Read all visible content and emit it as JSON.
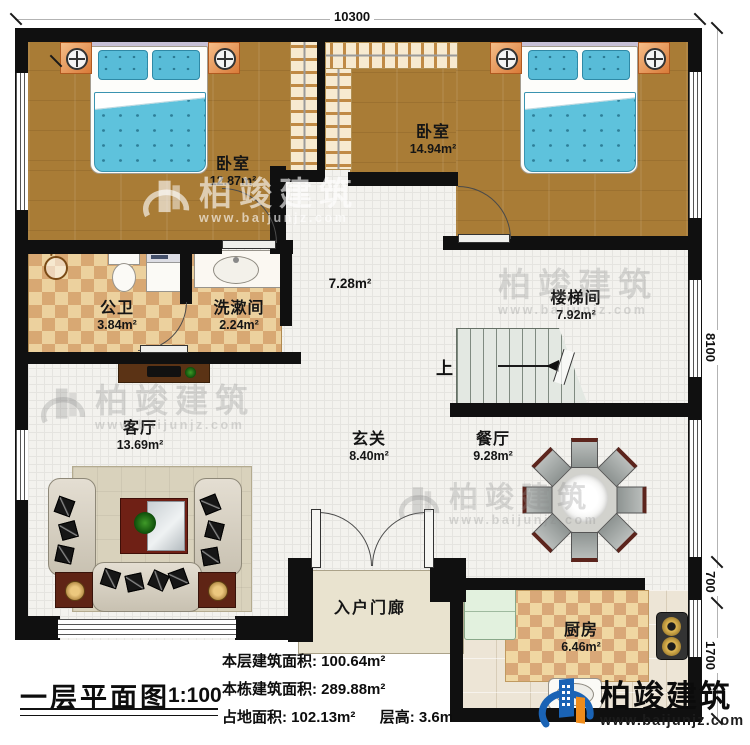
{
  "dimensions": {
    "top": "10300",
    "right_upper": "8100",
    "right_middle": "700",
    "right_lower": "1700"
  },
  "rooms": {
    "bedroom1": {
      "name": "卧室",
      "area": "12.87m²"
    },
    "bedroom2": {
      "name": "卧室",
      "area": "14.94m²"
    },
    "bathroom": {
      "name": "公卫",
      "area": "3.84m²"
    },
    "washroom": {
      "name": "洗漱间",
      "area": "2.24m²"
    },
    "hallway": {
      "area": "7.28m²"
    },
    "stairwell": {
      "name": "楼梯间",
      "area": "7.92m²",
      "up_label": "上"
    },
    "living_room": {
      "name": "客厅",
      "area": "13.69m²"
    },
    "foyer": {
      "name": "玄关",
      "area": "8.40m²"
    },
    "dining_room": {
      "name": "餐厅",
      "area": "9.28m²"
    },
    "entry_porch": {
      "name": "入户门廊"
    },
    "kitchen": {
      "name": "厨房",
      "area": "6.46m²"
    }
  },
  "title_block": {
    "title": "一层平面图",
    "scale": "1:100",
    "stats": {
      "line1_label": "本层建筑面积:",
      "line1_value": "100.64m²",
      "line2_label": "本栋建筑面积:",
      "line2_value": "289.88m²",
      "line3_label": "占地面积:",
      "line3_value": "102.13m²",
      "line3b_label": "层高:",
      "line3b_value": "3.6m"
    }
  },
  "branding": {
    "watermark_name": "柏竣建筑",
    "watermark_url": "www.baijunjz.com",
    "logo_name": "柏竣建筑",
    "logo_url": "www.baijunjz.com"
  },
  "colors": {
    "wall": "#101010",
    "wood_floor": "#a97c36",
    "bed_blue": "#5ec2dc",
    "checker_tan": "#d8a873",
    "logo_blue": "#1a63b5",
    "logo_orange": "#ef8c1c"
  }
}
